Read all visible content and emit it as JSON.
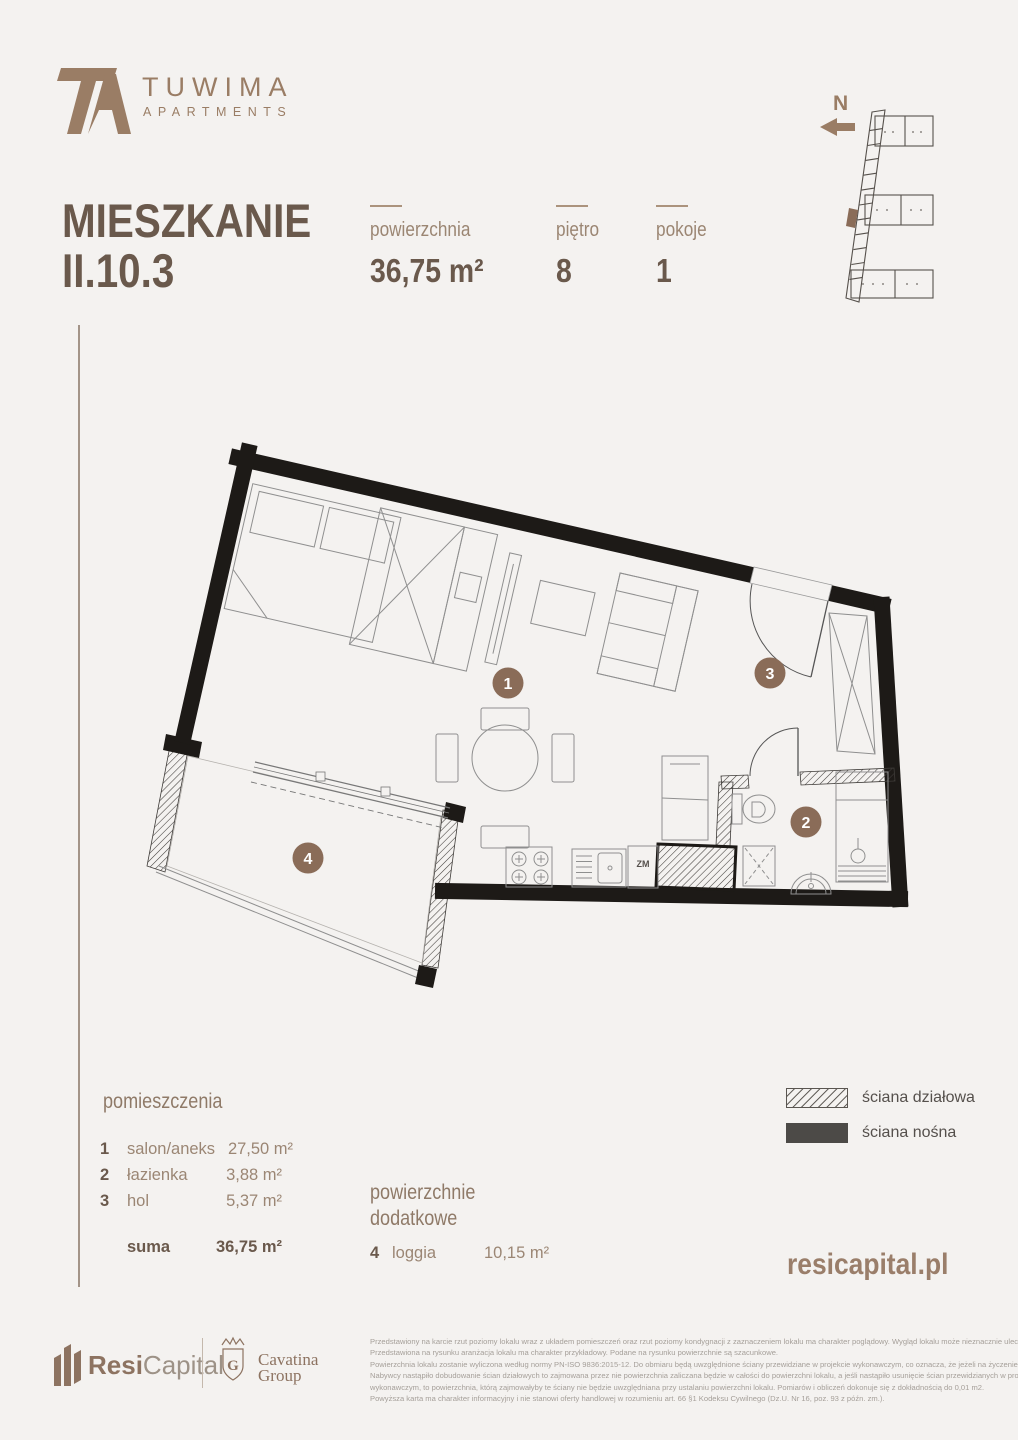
{
  "brand": {
    "name": "TUWIMA",
    "subtitle": "APARTMENTS"
  },
  "title": {
    "label": "MIESZKANIE",
    "unit": "II.10.3"
  },
  "stats": {
    "area": {
      "label": "powierzchnia",
      "value": "36,75 m²"
    },
    "floor": {
      "label": "piętro",
      "value": "8"
    },
    "rooms": {
      "label": "pokoje",
      "value": "1"
    }
  },
  "compass": {
    "north_label": "N"
  },
  "plan": {
    "markers": {
      "living": "1",
      "bath": "2",
      "hall": "3",
      "loggia": "4"
    },
    "dishwasher_label": "ZM"
  },
  "rooms_table": {
    "heading": "pomieszczenia",
    "items": [
      {
        "num": "1",
        "name": "salon/aneks",
        "area": "27,50 m²"
      },
      {
        "num": "2",
        "name": "łazienka",
        "area": "3,88 m²"
      },
      {
        "num": "3",
        "name": "hol",
        "area": "5,37 m²"
      }
    ],
    "sum_label": "suma",
    "sum_value": "36,75 m²"
  },
  "additional": {
    "heading": "powierzchnie dodatkowe",
    "items": [
      {
        "num": "4",
        "name": "loggia",
        "area": "10,15 m²"
      }
    ]
  },
  "legend": {
    "partition": "ściana działowa",
    "load_bearing": "ściana nośna"
  },
  "website": "resicapital.pl",
  "footer": {
    "resi": {
      "bold": "Resi",
      "light": "Capital"
    },
    "cavatina": {
      "initial": "G",
      "line1": "Cavatina",
      "line2": "Group"
    },
    "disclaimer": [
      "Przedstawiony na karcie rzut poziomy lokalu wraz z układem pomieszczeń oraz rzut poziomy kondygnacji z zaznaczeniem lokalu ma charakter poglądowy. Wygląd lokalu może nieznacznie ulec zmianie.",
      "Przedstawiona na rysunku aranżacja lokalu ma charakter przykładowy. Podane na rysunku powierzchnie są szacunkowe.",
      "Powierzchnia lokalu zostanie wyliczona według normy PN-ISO 9836:2015-12. Do obmiaru będą uwzględnione ściany przewidziane w projekcie wykonawczym, co oznacza, że jeżeli na życzenie",
      "Nabywcy nastąpiło dobudowanie ścian działowych to zajmowana przez nie powierzchnia zaliczana będzie w całości do powierzchni lokalu, a jeśli nastąpiło usunięcie ścian przewidzianych w projekcie",
      "wykonawczym, to powierzchnia, którą zajmowałyby te ściany nie będzie uwzględniana przy ustalaniu powierzchni lokalu. Pomiarów i obliczeń dokonuje się z dokładnością do 0,01 m2.",
      "Powyższa karta ma charakter informacyjny i nie stanowi oferty handlowej w rozumieniu art. 66 §1 Kodeksu Cywilnego (Dz.U. Nr 16, poz. 93 z późn. zm.)."
    ]
  },
  "colors": {
    "accent": "#9a7d65",
    "dark": "#6a594c",
    "wall": "#1d1a17",
    "marker": "#8a6c58"
  }
}
